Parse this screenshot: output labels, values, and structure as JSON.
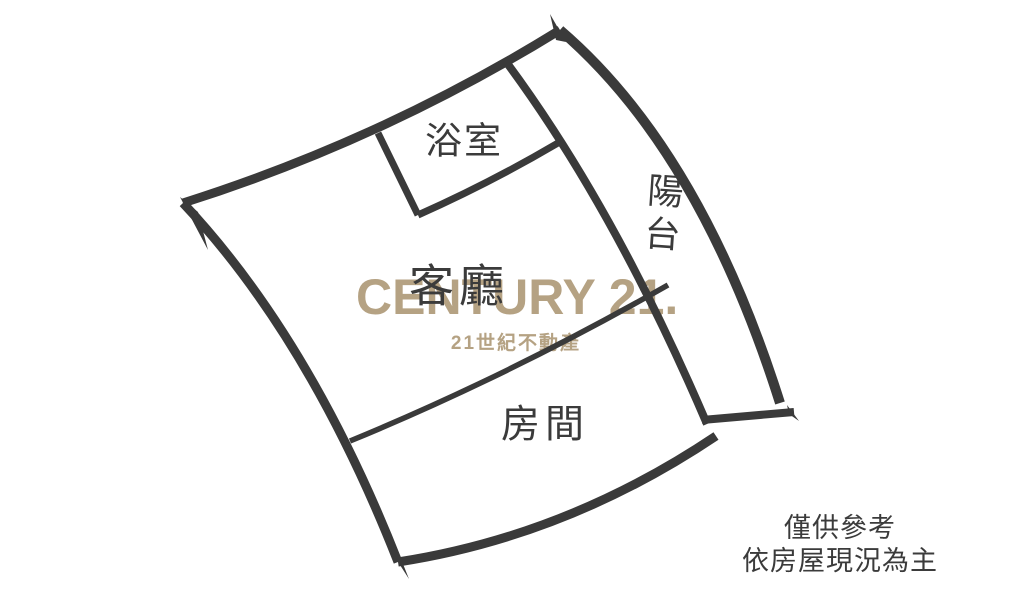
{
  "page": {
    "background": "#ffffff"
  },
  "floorplan": {
    "wall_color": "#3a3a3a",
    "label_color": "#3b3b3b",
    "rooms": {
      "bathroom": {
        "label": "浴室"
      },
      "living_room": {
        "label": "客廳"
      },
      "balcony": {
        "label": "陽台"
      },
      "bedroom": {
        "label": "房間"
      }
    }
  },
  "watermark": {
    "brand": "CENTURY 21.",
    "registered": "®",
    "subtitle": "21世紀不動產",
    "color": "#b5a283"
  },
  "disclaimer": {
    "line1": "僅供參考",
    "line2": "依房屋現況為主",
    "color": "#3b3b3b"
  }
}
